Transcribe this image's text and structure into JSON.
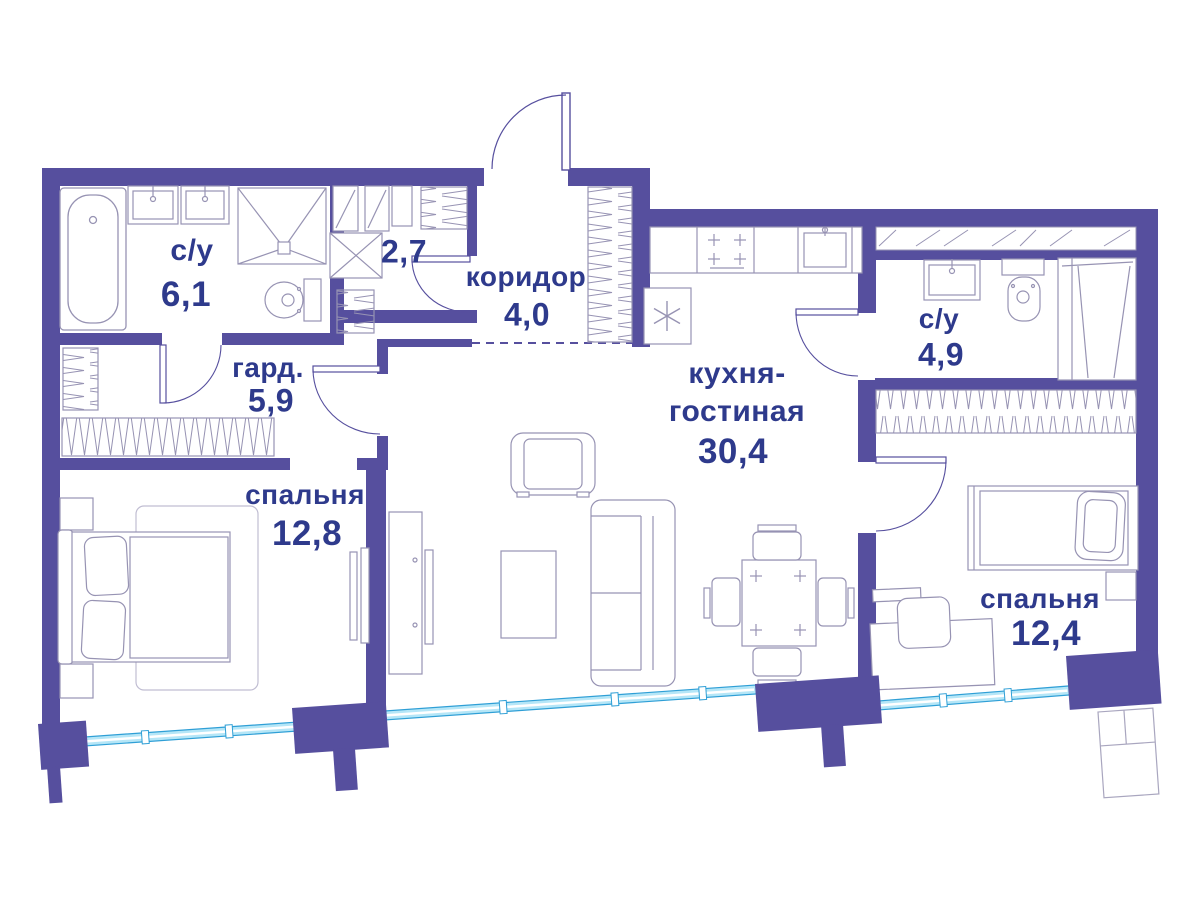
{
  "colors": {
    "wall": "#564f9e",
    "label_text": "#2e3a8c",
    "furniture_line": "#9793b3",
    "window_line": "#2f9fd6",
    "window_fill": "#b5e6f7"
  },
  "rooms": {
    "bath1": {
      "name": "с/у",
      "area": "6,1"
    },
    "laundry": {
      "area": "2,7"
    },
    "corridor": {
      "name": "коридор",
      "area": "4,0"
    },
    "wardrobe": {
      "name": "гард.",
      "area": "5,9"
    },
    "bedroom1": {
      "name": "спальня",
      "area": "12,8"
    },
    "kitchen_living": {
      "name_line1": "кухня-",
      "name_line2": "гостиная",
      "area": "30,4"
    },
    "bath2": {
      "name": "с/у",
      "area": "4,9"
    },
    "bedroom2": {
      "name": "спальня",
      "area": "12,4"
    }
  }
}
